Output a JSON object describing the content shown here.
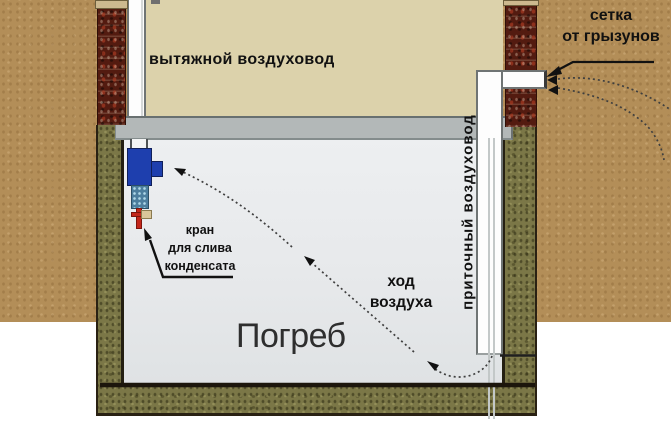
{
  "diagram": {
    "title_context": "cellar-ventilation-scheme",
    "labels": {
      "exhaust_duct": "вытяжной воздуховод",
      "rodent_mesh_line1": "сетка",
      "rodent_mesh_line2": "от грызунов",
      "supply_duct": "приточный воздуховод",
      "condensate_tap_line1": "кран",
      "condensate_tap_line2": "для слива",
      "condensate_tap_line3": "конденсата",
      "air_flow_line1": "ход",
      "air_flow_line2": "воздуха",
      "cellar": "Погреб",
      "pipe_height": "20-50 см"
    },
    "colors": {
      "soil": "#b38e58",
      "cellar_wall_green": "#7b7747",
      "interior": "#e8eaec",
      "ceiling_slab": "#b3b8b8",
      "house_beige": "#dcd2ab",
      "brick": "#531b10",
      "pipe_white": "#fdfdfd",
      "fan_blue": "#1e3fae",
      "condensate_teal": "#4c7e9e",
      "drain_red": "#c3261a",
      "dimension_white": "#ffffff",
      "annotation_black": "#111111"
    }
  }
}
